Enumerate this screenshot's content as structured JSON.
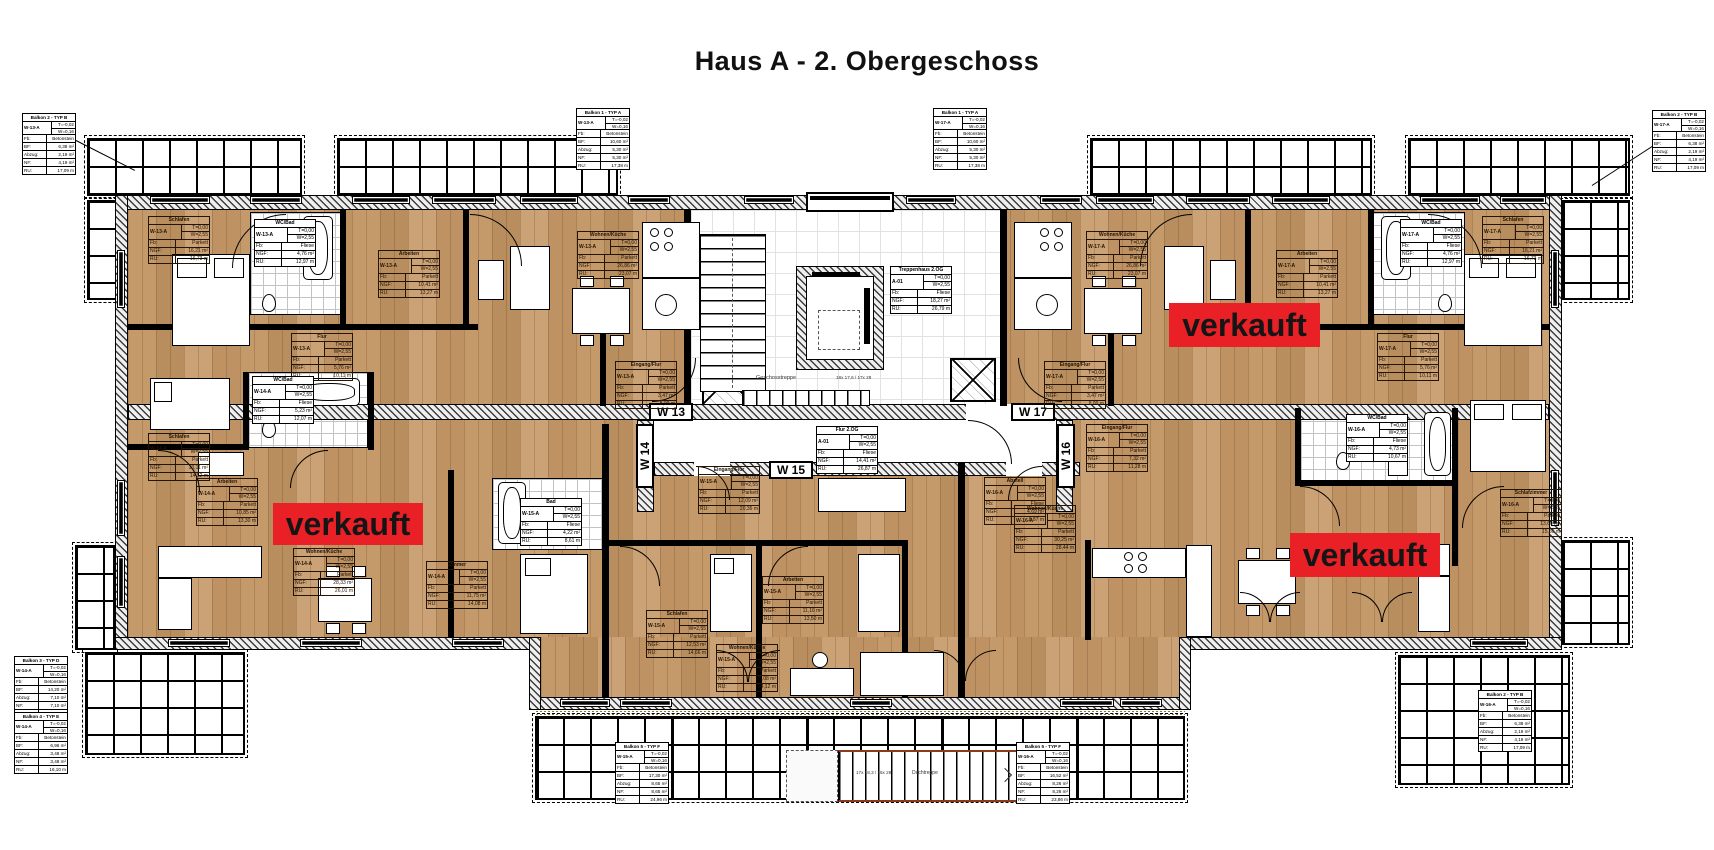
{
  "title": "Haus A - 2. Obergeschoss",
  "sold_banner": {
    "label": "verkauft",
    "bg": "#e92127"
  },
  "unit_labels": {
    "w13": "W 13",
    "w14": "W 14",
    "w15": "W 15",
    "w16": "W 16",
    "w17": "W 17"
  },
  "stairwell": {
    "label": "Geschosstreppe",
    "flight_note": "18x 17,6 / 17x 28"
  },
  "outer_stair": {
    "label": "Dachtreppe",
    "note": "17x 18,3 / 16x 28"
  },
  "field_labels": {
    "fb": "Fb:",
    "ngf": "NGF:",
    "ru": "RU:",
    "bf": "BF:",
    "abzug": "Abzug:",
    "nf": "NF:"
  },
  "room_tables": [
    {
      "name": "Schlafen",
      "unit": "W-13-A",
      "v1": "T=0,00",
      "v2": "W=2,55",
      "fb": "Parkett",
      "ngf": "16,21 m²",
      "ru": "16,73 m"
    },
    {
      "name": "WC/Bad",
      "unit": "W-13-A",
      "v1": "T=0,00",
      "v2": "W=2,55",
      "fb": "Fliese",
      "ngf": "4,76 m²",
      "ru": "12,97 m"
    },
    {
      "name": "Arbeiten",
      "unit": "W-13-A",
      "v1": "T=0,00",
      "v2": "W=2,55",
      "fb": "Parkett",
      "ngf": "10,41 m²",
      "ru": "13,27 m"
    },
    {
      "name": "Flur",
      "unit": "W-13-A",
      "v1": "T=0,00",
      "v2": "W=2,55",
      "fb": "Parkett",
      "ngf": "5,76 m²",
      "ru": "10,11 m"
    },
    {
      "name": "Wohnen/Küche",
      "unit": "W-13-A",
      "v1": "T=0,00",
      "v2": "W=2,55",
      "fb": "Parkett",
      "ngf": "26,86 m²",
      "ru": "23,07 m"
    },
    {
      "name": "Eingang/Flur",
      "unit": "W-13-A",
      "v1": "T=0,00",
      "v2": "W=2,55",
      "fb": "Parkett",
      "ngf": "3,47 m²",
      "ru": "8,09 m"
    },
    {
      "name": "Schlafen",
      "unit": "W-17-A",
      "v1": "T=0,00",
      "v2": "W=2,55",
      "fb": "Parkett",
      "ngf": "16,21 m²",
      "ru": "16,73 m"
    },
    {
      "name": "WC/Bad",
      "unit": "W-17-A",
      "v1": "T=0,00",
      "v2": "W=2,55",
      "fb": "Fliese",
      "ngf": "4,76 m²",
      "ru": "12,97 m"
    },
    {
      "name": "Arbeiten",
      "unit": "W-17-A",
      "v1": "T=0,00",
      "v2": "W=2,55",
      "fb": "Parkett",
      "ngf": "10,41 m²",
      "ru": "13,27 m"
    },
    {
      "name": "Flur",
      "unit": "W-17-A",
      "v1": "T=0,00",
      "v2": "W=2,55",
      "fb": "Parkett",
      "ngf": "5,76 m²",
      "ru": "10,11 m"
    },
    {
      "name": "Wohnen/Küche",
      "unit": "W-17-A",
      "v1": "T=0,00",
      "v2": "W=2,55",
      "fb": "Parkett",
      "ngf": "26,86 m²",
      "ru": "23,07 m"
    },
    {
      "name": "Eingang/Flur",
      "unit": "W-17-A",
      "v1": "T=0,00",
      "v2": "W=2,55",
      "fb": "Parkett",
      "ngf": "3,47 m²",
      "ru": "8,09 m"
    },
    {
      "name": "Flur 2.OG",
      "unit": "A-01",
      "v1": "T=0,00",
      "v2": "W=2,55",
      "fb": "Fliese",
      "ngf": "14,41 m²",
      "ru": "26,87 m"
    },
    {
      "name": "Treppenhaus 2.OG",
      "unit": "A-01",
      "v1": "T=0,00",
      "v2": "W=2,55",
      "fb": "Fliese",
      "ngf": "18,27 m²",
      "ru": "26,79 m"
    },
    {
      "name": "Schlafen",
      "unit": "W-14-A",
      "v1": "T=0,00",
      "v2": "W=2,55",
      "fb": "Parkett",
      "ngf": "13,11 m²",
      "ru": "14,52 m"
    },
    {
      "name": "WC/Bad",
      "unit": "W-14-A",
      "v1": "T=0,00",
      "v2": "W=2,55",
      "fb": "Fliese",
      "ngf": "5,23 m²",
      "ru": "12,07 m"
    },
    {
      "name": "Arbeiten",
      "unit": "W-14-A",
      "v1": "T=0,00",
      "v2": "W=2,55",
      "fb": "Parkett",
      "ngf": "10,85 m²",
      "ru": "13,30 m"
    },
    {
      "name": "Wohnen/Küche",
      "unit": "W-14-A",
      "v1": "T=0,00",
      "v2": "W=2,55",
      "fb": "Parkett",
      "ngf": "28,33 m²",
      "ru": "26,01 m"
    },
    {
      "name": "Zimmer",
      "unit": "W-14-A",
      "v1": "T=0,00",
      "v2": "W=2,55",
      "fb": "Parkett",
      "ngf": "11,75 m²",
      "ru": "14,08 m"
    },
    {
      "name": "Eingang/Flur",
      "unit": "W-15-A",
      "v1": "T=0,00",
      "v2": "W=2,55",
      "fb": "Parkett",
      "ngf": "12,09 m²",
      "ru": "20,36 m"
    },
    {
      "name": "Bad",
      "unit": "W-15-A",
      "v1": "T=0,00",
      "v2": "W=2,55",
      "fb": "Fliese",
      "ngf": "4,22 m²",
      "ru": "8,61 m"
    },
    {
      "name": "Arbeiten",
      "unit": "W-15-A",
      "v1": "T=0,00",
      "v2": "W=2,55",
      "fb": "Parkett",
      "ngf": "11,16 m²",
      "ru": "13,50 m"
    },
    {
      "name": "Schlafen",
      "unit": "W-15-A",
      "v1": "T=0,00",
      "v2": "W=2,55",
      "fb": "Parkett",
      "ngf": "12,53 m²",
      "ru": "14,66 m"
    },
    {
      "name": "Wohnen/Küche",
      "unit": "W-15-A",
      "v1": "T=0,00",
      "v2": "W=2,55",
      "fb": "Parkett",
      "ngf": "25,08 m²",
      "ru": "24,12 m"
    },
    {
      "name": "Abstell",
      "unit": "W-16-A",
      "v1": "T=0,00",
      "v2": "W=2,55",
      "fb": "Fliese",
      "ngf": "4,69 m²",
      "ru": "8,87 m"
    },
    {
      "name": "Eingang/Flur",
      "unit": "W-16-A",
      "v1": "T=0,00",
      "v2": "W=2,55",
      "fb": "Parkett",
      "ngf": "7,32 m²",
      "ru": "11,28 m"
    },
    {
      "name": "Wohnen/Küche",
      "unit": "W-16-A",
      "v1": "T=0,00",
      "v2": "W=2,55",
      "fb": "Parkett",
      "ngf": "30,25 m²",
      "ru": "28,44 m"
    },
    {
      "name": "WC/Bad",
      "unit": "W-16-A",
      "v1": "T=0,00",
      "v2": "W=2,55",
      "fb": "Fliese",
      "ngf": "4,73 m²",
      "ru": "10,67 m"
    },
    {
      "name": "Schlafzimmer",
      "unit": "W-16-A",
      "v1": "T=0,00",
      "v2": "W=2,55",
      "fb": "Parkett",
      "ngf": "13,60 m²",
      "ru": "15,50 m"
    }
  ],
  "balcony_tables": [
    {
      "name": "Balkon 2 - TYP B",
      "unit": "W-13-A",
      "v1": "T=-0,02",
      "v2": "W=0,16",
      "fb": "Betonstein",
      "bf": "6,38 m²",
      "abzug": "2,19 m²",
      "nf": "4,19 m²",
      "ru": "17,09 m"
    },
    {
      "name": "Balkon 1 - TYP A",
      "unit": "W-13-A",
      "v1": "T=-0,02",
      "v2": "W=0,16",
      "fb": "Betonstein",
      "bf": "10,60 m²",
      "abzug": "5,30 m²",
      "nf": "5,30 m²",
      "ru": "17,38 m"
    },
    {
      "name": "Balkon 1 - TYP A",
      "unit": "W-17-A",
      "v1": "T=-0,02",
      "v2": "W=0,16",
      "fb": "Betonstein",
      "bf": "10,60 m²",
      "abzug": "5,30 m²",
      "nf": "5,30 m²",
      "ru": "17,38 m"
    },
    {
      "name": "Balkon 2 - TYP B",
      "unit": "W-17-A",
      "v1": "T=-0,02",
      "v2": "W=0,16",
      "fb": "Betonstein",
      "bf": "6,38 m²",
      "abzug": "2,19 m²",
      "nf": "4,19 m²",
      "ru": "17,09 m"
    },
    {
      "name": "Balkon 3 - TYP D",
      "unit": "W-14-A",
      "v1": "T=-0,02",
      "v2": "W=0,16",
      "fb": "Betonstein",
      "bf": "14,20 m²",
      "abzug": "7,10 m²",
      "nf": "7,10 m²",
      "ru": "21,40 m"
    },
    {
      "name": "Balkon 4 - TYP E",
      "unit": "W-14-A",
      "v1": "T=-0,02",
      "v2": "W=0,16",
      "fb": "Betonstein",
      "bf": "6,96 m²",
      "abzug": "3,48 m²",
      "nf": "3,48 m²",
      "ru": "16,10 m"
    },
    {
      "name": "Balkon 5 - TYP F",
      "unit": "W-15-A",
      "v1": "T=-0,02",
      "v2": "W=0,16",
      "fb": "Betonstein",
      "bf": "17,30 m²",
      "abzug": "8,65 m²",
      "nf": "8,65 m²",
      "ru": "24,96 m"
    },
    {
      "name": "Balkon 5 - TYP F",
      "unit": "W-16-A",
      "v1": "T=-0,02",
      "v2": "W=0,16",
      "fb": "Betonstein",
      "bf": "16,52 m²",
      "abzug": "8,26 m²",
      "nf": "8,26 m²",
      "ru": "23,86 m"
    },
    {
      "name": "Balkon 2 - TYP B",
      "unit": "W-16-A",
      "v1": "T=-0,02",
      "v2": "W=0,16",
      "fb": "Betonstein",
      "bf": "6,38 m²",
      "abzug": "2,19 m²",
      "nf": "4,19 m²",
      "ru": "17,09 m"
    }
  ]
}
